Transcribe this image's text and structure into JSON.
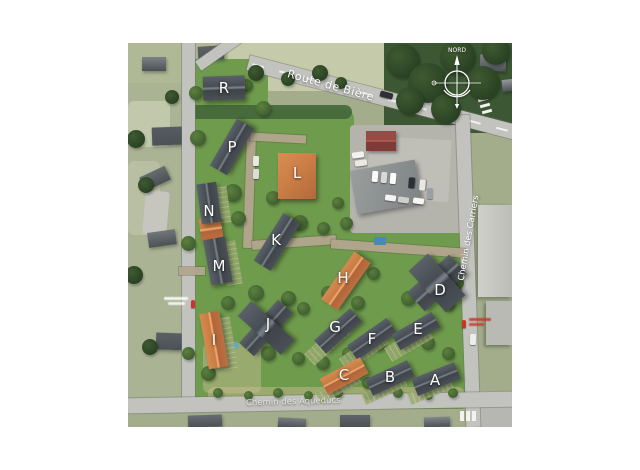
{
  "map": {
    "compass": {
      "north_label": "NORD"
    },
    "streets": {
      "top": "Route de Bière",
      "right": "Chemin des Carriers",
      "bottom": "Chemin des Aqueducs"
    },
    "buildings": [
      {
        "label": "R",
        "roof": "slate"
      },
      {
        "label": "P",
        "roof": "slate"
      },
      {
        "label": "L",
        "roof": "orange"
      },
      {
        "label": "N",
        "roof": "slate"
      },
      {
        "label": "M",
        "roof": "slate"
      },
      {
        "label": "K",
        "roof": "slate"
      },
      {
        "label": "J",
        "roof": "slate"
      },
      {
        "label": "I",
        "roof": "orange"
      },
      {
        "label": "H",
        "roof": "orange"
      },
      {
        "label": "D",
        "roof": "slate"
      },
      {
        "label": "G",
        "roof": "slate"
      },
      {
        "label": "F",
        "roof": "slate"
      },
      {
        "label": "E",
        "roof": "slate"
      },
      {
        "label": "C",
        "roof": "orange"
      },
      {
        "label": "B",
        "roof": "slate"
      },
      {
        "label": "A",
        "roof": "slate"
      }
    ],
    "markers": [
      {
        "name": "red-map-pin",
        "side": "left"
      },
      {
        "name": "red-map-pin",
        "side": "right"
      }
    ],
    "colors": {
      "development_green": "#6f9b4d",
      "slate_roof": "#4a5057",
      "orange_roof": "#c1763f",
      "road_gray": "#c2c3bf",
      "marker_red": "#d03227"
    }
  }
}
